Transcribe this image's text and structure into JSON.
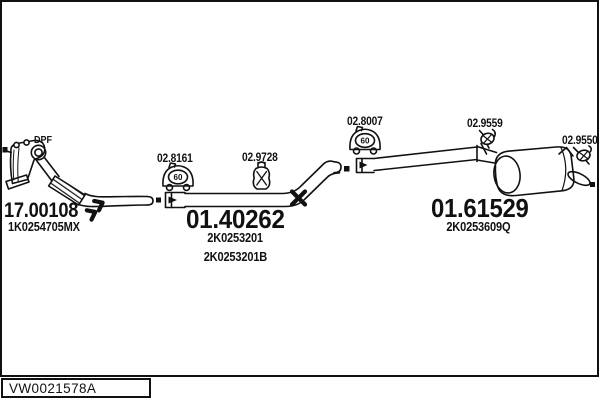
{
  "drawing": {
    "code": "VW0021578A",
    "dpf_tag": "DPF",
    "clamp_diameter": "60"
  },
  "parts": {
    "front": {
      "number": "17.00108",
      "oe": "1K0254705MX"
    },
    "center": {
      "number": "01.40262",
      "oe1": "2K0253201",
      "oe2": "2K0253201B"
    },
    "rear": {
      "number": "01.61529",
      "oe": "2K0253609Q"
    }
  },
  "fittings": {
    "clamp1": "02.8161",
    "hanger1": "02.9728",
    "clamp2": "02.8007",
    "hanger2": "02.9559",
    "hanger3": "02.9550"
  },
  "colors": {
    "line": "#111111",
    "background": "#ffffff"
  }
}
